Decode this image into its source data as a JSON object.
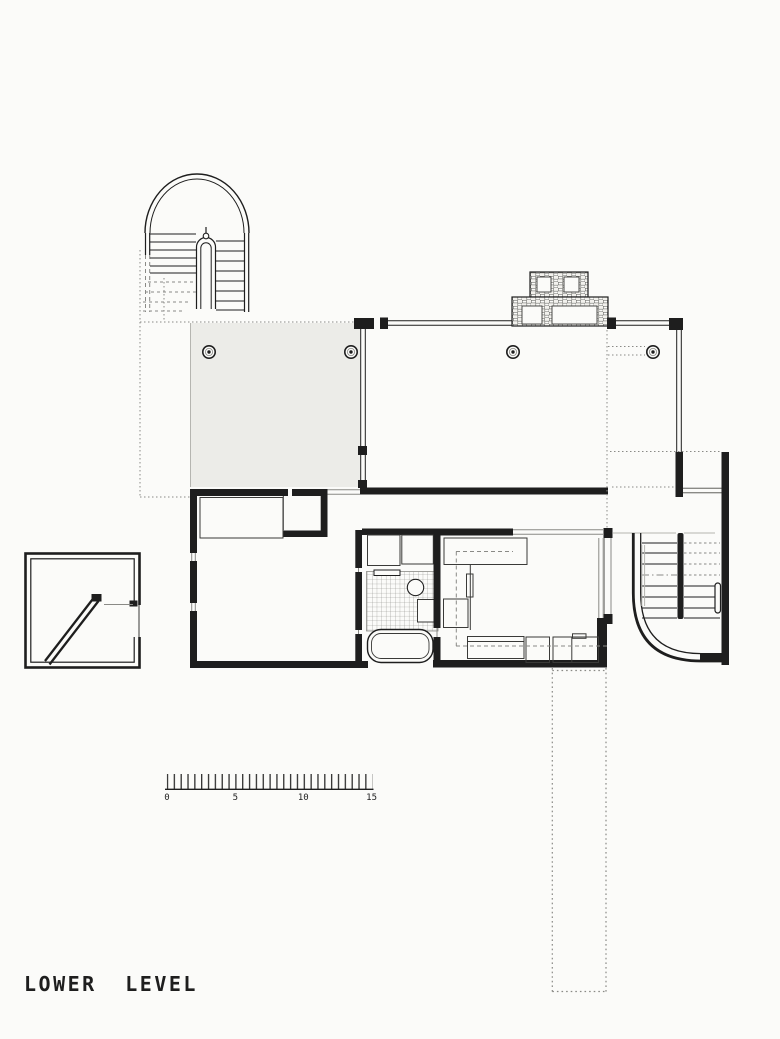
{
  "title": "LOWER LEVEL",
  "scale_bar": {
    "labels": [
      "0",
      "5",
      "10",
      "15"
    ]
  },
  "colors": {
    "ink": "#1e1e1e",
    "thin": "#3a3a38",
    "mid": "#8a8a86",
    "gray": "#b5b5b0",
    "tint": "#ecece8",
    "paper": "#fbfbf9"
  }
}
